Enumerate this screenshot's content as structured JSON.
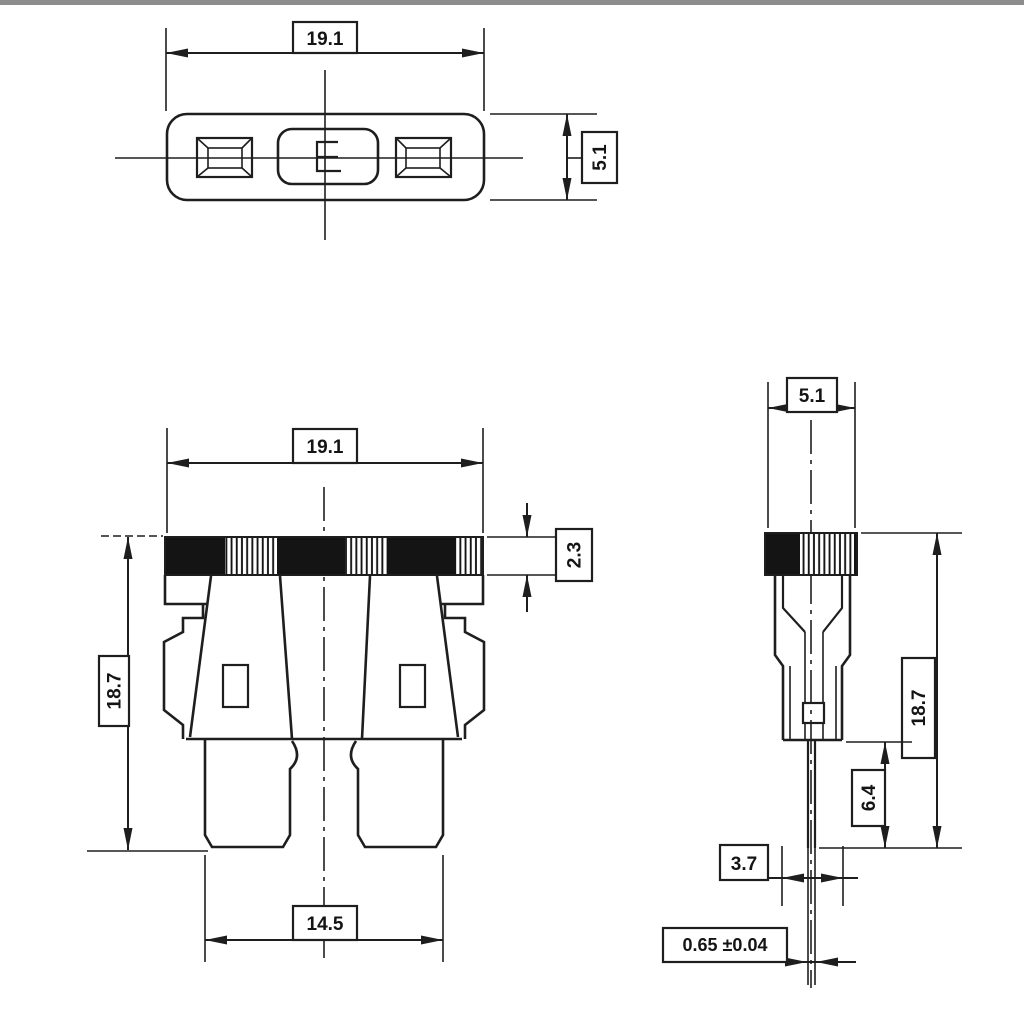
{
  "drawing": {
    "kind": "technical-dimension-drawing",
    "subject": "automotive blade fuse, three orthographic views"
  },
  "views": {
    "top": {
      "width": "19.1",
      "height": "5.1"
    },
    "front": {
      "width": "19.1",
      "band_height": "2.3",
      "height": "18.7",
      "blade_span": "14.5"
    },
    "side": {
      "width": "5.1",
      "height": "18.7",
      "blade_length": "6.4",
      "bottom_width": "3.7",
      "blade_thickness": "0.65 ±0.04"
    }
  },
  "colors": {
    "line": "#1e1e1e",
    "background": "#ffffff",
    "band_fill": "#141414",
    "scan_border": "#8d8d8d"
  }
}
